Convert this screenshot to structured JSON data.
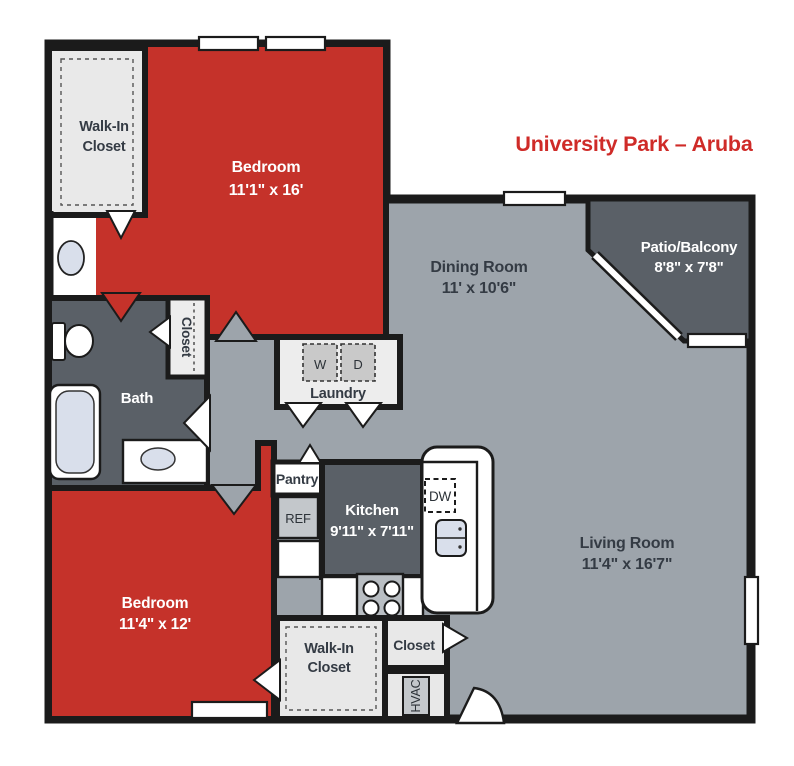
{
  "title": {
    "text": "University Park – Aruba"
  },
  "colors": {
    "accent_red": "#c5322a",
    "title_red": "#cf2b28",
    "floor_gray": "#9da4ab",
    "dark_room_gray": "#5a6067",
    "closet_light": "#e9e9e9",
    "appliance_gray": "#c3c7cb",
    "wall_black": "#1b1b1b",
    "fixture_blue": "#d9dfeb",
    "label_dark": "#343b44"
  },
  "rooms": {
    "bedroom1": {
      "name": "Bedroom",
      "dims": "11'1\" x 16'"
    },
    "bedroom2": {
      "name": "Bedroom",
      "dims": "11'4\" x 12'"
    },
    "dining": {
      "name": "Dining Room",
      "dims": "11' x 10'6\""
    },
    "living": {
      "name": "Living Room",
      "dims": "11'4\" x 16'7\""
    },
    "kitchen": {
      "name": "Kitchen",
      "dims": "9'11\" x 7'11\""
    },
    "patio": {
      "name": "Patio/Balcony",
      "dims": "8'8\" x 7'8\""
    },
    "walk_in_closet_1": {
      "line1": "Walk-In",
      "line2": "Closet"
    },
    "walk_in_closet_2": {
      "line1": "Walk-In",
      "line2": "Closet"
    },
    "bath": {
      "name": "Bath"
    },
    "laundry": {
      "name": "Laundry"
    },
    "hall_closet": {
      "name": "Closet"
    },
    "living_closet": {
      "name": "Closet"
    },
    "pantry": {
      "name": "Pantry"
    }
  },
  "appliances": {
    "washer": "W",
    "dryer": "D",
    "refrigerator": "REF",
    "dishwasher": "DW",
    "hvac": "HVAC"
  }
}
